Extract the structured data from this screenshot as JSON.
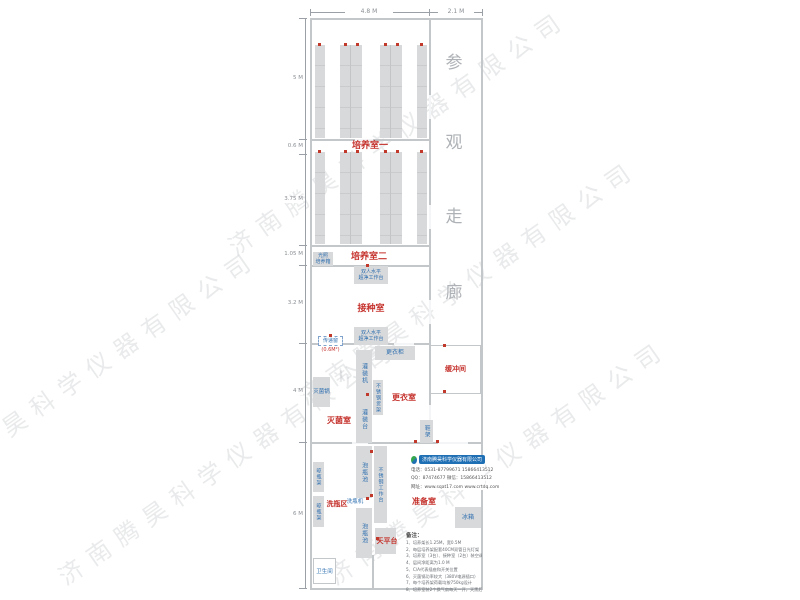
{
  "watermark_text": "济南腾昊科学仪器有限公司",
  "dimensions": {
    "top": [
      "4.8 M",
      "2.1 M"
    ],
    "left": [
      "5 M",
      "0.6 M",
      "3.75 M",
      "1.05 M",
      "3.2 M",
      "4 M",
      "6 M"
    ]
  },
  "corridor_chars": [
    "参",
    "观",
    "走",
    "廊"
  ],
  "rooms": {
    "culture1": "培养室一",
    "culture2": "培养室二",
    "inoculation": "接种室",
    "buffer": "缓冲间",
    "changing": "更衣室",
    "sterilize": "灭菌室",
    "washing": "洗瓶区",
    "prep": "准备室",
    "balance": "天平台",
    "toilet": "卫生间"
  },
  "equipment": {
    "light_incubator_l1": "光照",
    "light_incubator_l2": "培养箱",
    "bench_l1": "双人水平",
    "bench_l2": "超净工作台",
    "pass_window": "传递窗",
    "pass_window_size": "(0.6M²)",
    "wardrobe": "更衣柜",
    "filling_machine": "灌装机",
    "autoclave": "灭菌锅",
    "steel_shelf": "不锈钢货架",
    "filling_table": "灌装台",
    "shoe_rack": "鞋架",
    "soak_pool": "泡瓶池",
    "steel_bench": "不锈钢工作台",
    "drying_rack": "晾瓶架",
    "bottle_washer": "洗瓶机",
    "fridge": "冰箱"
  },
  "company": {
    "name": "济南腾昊科学仪器有限公司",
    "phone": "电话：0531-87799671  15866413512",
    "qq": "QQ：87474677  微信：15866413512",
    "web": "网址：www.sqat17.com  www.crtdq.com"
  },
  "notes": {
    "title": "备注：",
    "items": [
      "1、培养架长1.25M，宽0.5M",
      "2、每层培养架配套40CM双管日光灯架",
      "3、培养室（3台）、接种室（2台）装空调",
      "4、层间净距离为1.0 M",
      "5、C/A代表插座和开关位置",
      "6、灭菌锅功率较大（380V电源插口）",
      "7、每个培养架荷载均按750kg设计",
      "8、培养室装2个换气扇每天一开，天黑后换气。"
    ]
  },
  "colors": {
    "room_label": "#c5322d",
    "equipment_label": "#2e6fb0",
    "rack_fill": "#d8d9da",
    "wall": "#c3c7ca",
    "marker": "#c0392b",
    "corridor_text": "#aeb2b6"
  }
}
